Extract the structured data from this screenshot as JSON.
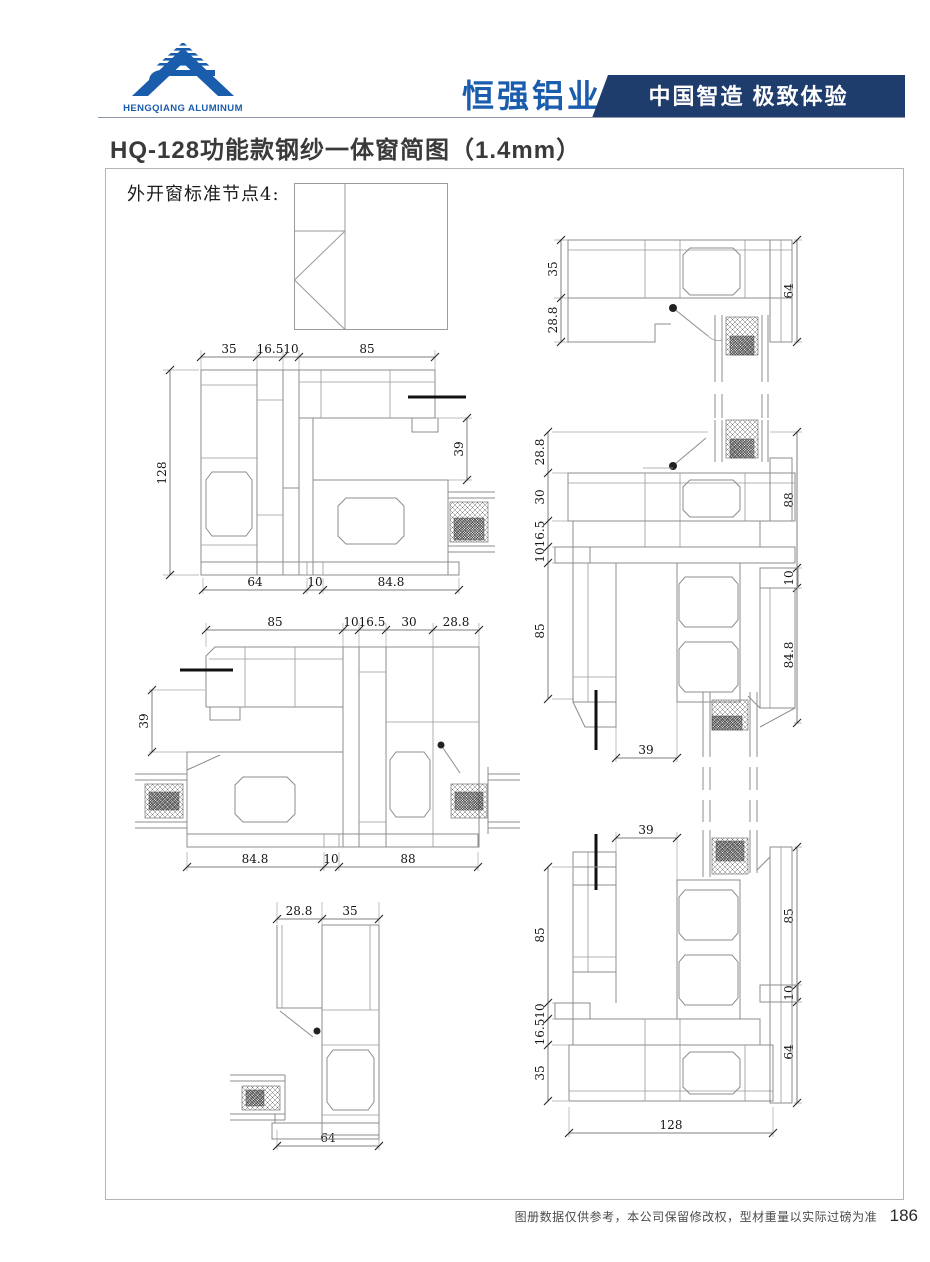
{
  "header": {
    "logo_subtext": "HENGQIANG ALUMINUM",
    "brand_name": "恒强铝业",
    "banner_slogan": "中国智造 极致体验",
    "colors": {
      "brand_blue": "#1a5dac",
      "banner_navy": "#1e3c6c"
    }
  },
  "title": "HQ-128功能款钢纱一体窗简图（1.4mm）",
  "canvas": {
    "node_label": "外开窗标准节点4:"
  },
  "dims": {
    "a": {
      "top": [
        "35",
        "16.5",
        "10",
        "85"
      ],
      "left": [
        "128"
      ],
      "right": [
        "39"
      ],
      "bottom": [
        "64",
        "10",
        "84.8"
      ]
    },
    "b": {
      "top": [
        "85",
        "10",
        "16.5",
        "30",
        "28.8"
      ],
      "left": [
        "39"
      ],
      "bottom": [
        "84.8",
        "10",
        "88"
      ]
    },
    "c": {
      "top": [
        "28.8",
        "35"
      ],
      "bottom": [
        "64"
      ]
    },
    "d": {
      "left": [
        "35",
        "28.8"
      ],
      "right": [
        "64"
      ]
    },
    "e": {
      "left": [
        "28.8",
        "30",
        "16.5",
        "10",
        "85"
      ],
      "right": [
        "88",
        "10",
        "84.8"
      ],
      "bottom": [
        "39"
      ]
    },
    "f": {
      "top": [
        "39"
      ],
      "left": [
        "85",
        "10",
        "16.5",
        "35"
      ],
      "right": [
        "85",
        "10",
        "64"
      ],
      "bottom": [
        "128"
      ]
    }
  },
  "footer": {
    "disclaimer": "图册数据仅供参考，本公司保留修改权，型材重量以实际过磅为准",
    "page_number": "186"
  }
}
